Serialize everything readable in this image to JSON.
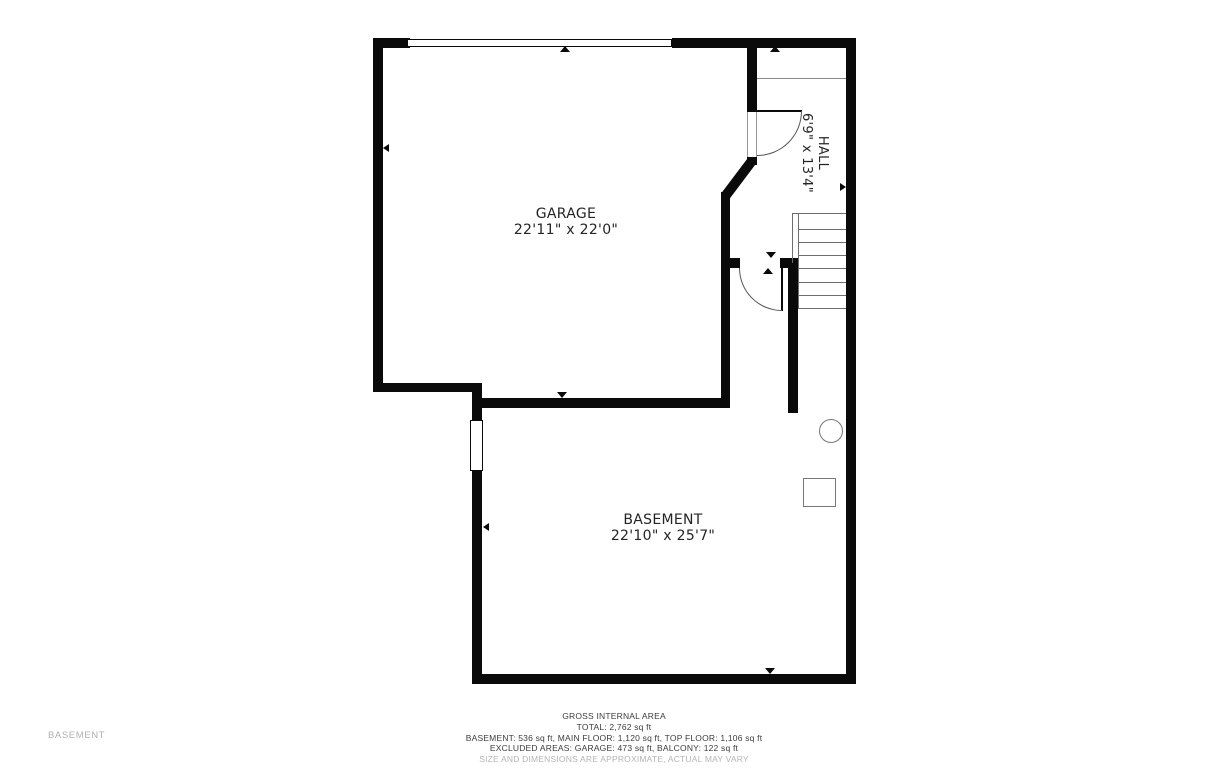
{
  "floor_label": "BASEMENT",
  "rooms": {
    "garage": {
      "name": "GARAGE",
      "dims": "22'11\" x 22'0\""
    },
    "basement": {
      "name": "BASEMENT",
      "dims": "22'10\" x 25'7\""
    },
    "hall": {
      "name": "HALL",
      "dims": "6'9\" x 13'4\""
    }
  },
  "footer": {
    "title": "GROSS INTERNAL AREA",
    "total": "TOTAL: 2,762 sq ft",
    "floors": "BASEMENT: 536 sq ft, MAIN FLOOR: 1,120 sq ft, TOP FLOOR: 1,106 sq ft",
    "excluded": "EXCLUDED AREAS: GARAGE: 473 sq ft, BALCONY: 122 sq ft",
    "disclaimer": "SIZE AND DIMENSIONS ARE APPROXIMATE, ACTUAL MAY VARY"
  },
  "colors": {
    "wall": "#0a0a0a",
    "thin_line": "#6e6e6e",
    "label_text": "#242424",
    "muted_text": "#b5b5b5"
  }
}
